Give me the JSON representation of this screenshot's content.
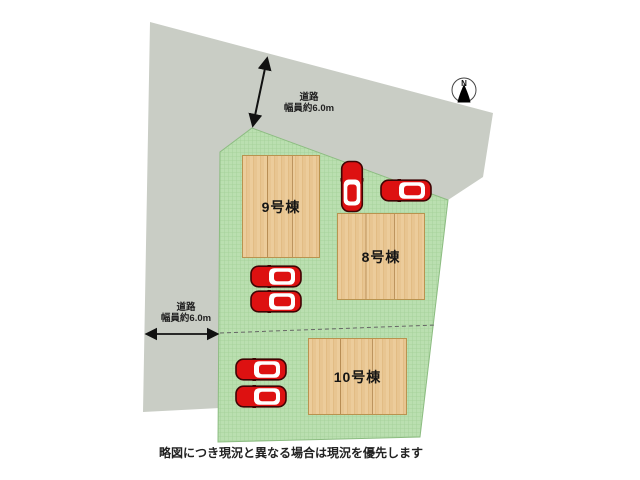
{
  "caption": "略図につき現況と異なる場合は現況を優先します",
  "compass": {
    "label": "N"
  },
  "roads": [
    {
      "id": "top-road",
      "name": "道路",
      "width_label": "幅員約6.0m"
    },
    {
      "id": "left-road",
      "name": "道路",
      "width_label": "幅員約6.0m"
    }
  ],
  "buildings": [
    {
      "id": "9",
      "label": "9号棟",
      "x": 242,
      "y": 155,
      "w": 78,
      "h": 103
    },
    {
      "id": "8",
      "label": "8号棟",
      "x": 337,
      "y": 213,
      "w": 88,
      "h": 87
    },
    {
      "id": "10",
      "label": "10号棟",
      "x": 308,
      "y": 338,
      "w": 99,
      "h": 77
    }
  ],
  "cars": [
    {
      "cx": 352,
      "cy": 186,
      "orientation": "up"
    },
    {
      "cx": 406,
      "cy": 190,
      "orientation": "left"
    },
    {
      "cx": 276,
      "cy": 276,
      "orientation": "left"
    },
    {
      "cx": 276,
      "cy": 301,
      "orientation": "left"
    },
    {
      "cx": 261,
      "cy": 369,
      "orientation": "left"
    },
    {
      "cx": 261,
      "cy": 396,
      "orientation": "left"
    }
  ],
  "colors": {
    "road_gray": "#c9cdc5",
    "lot_green": "#badfb0",
    "wood_tan": "#e8c591",
    "car_red": "#dd1111"
  }
}
